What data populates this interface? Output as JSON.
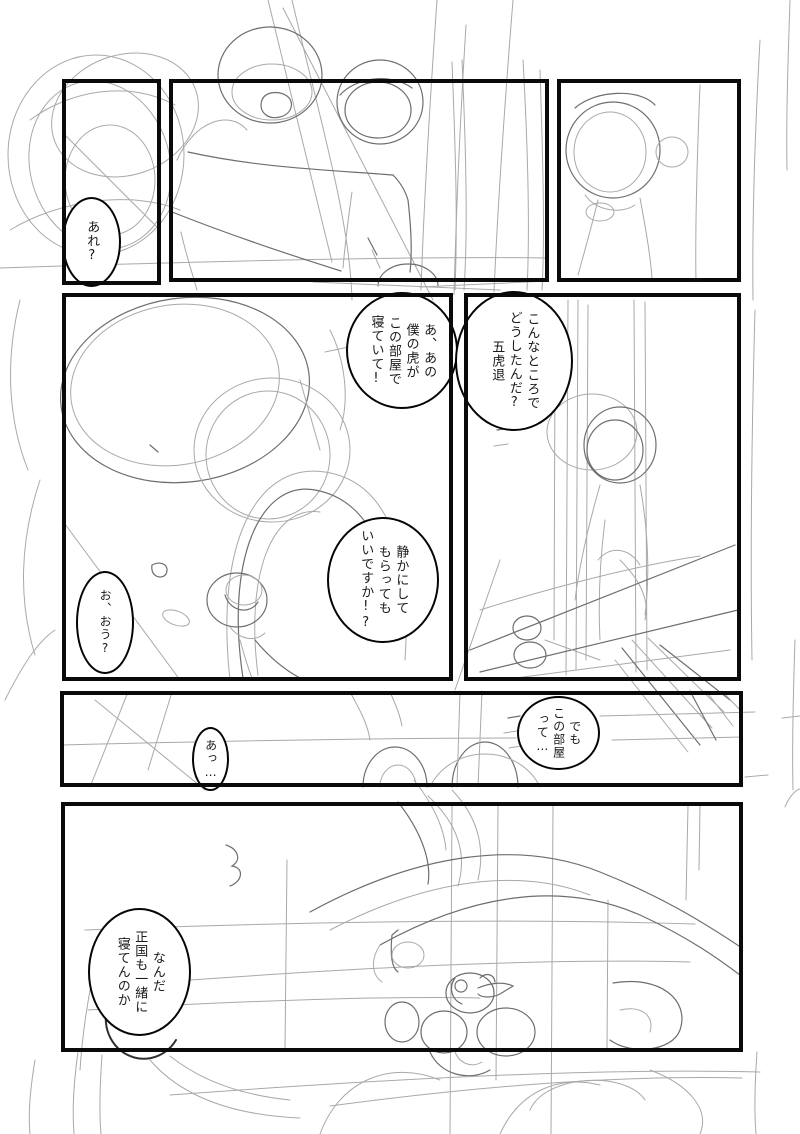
{
  "page": {
    "type": "manga-name-rough-sketch",
    "colors": {
      "bg": "#ffffff",
      "panel_border": "#0a0a0a",
      "bubble_border": "#050505",
      "text": "#1a1a1a",
      "sketch_light": "#a9a9a9",
      "sketch_dark": "#6e6e6e",
      "sketch_darkest": "#2f2f2f"
    }
  },
  "bubbles": {
    "are": {
      "text": "あれ?"
    },
    "boku_no_tora": {
      "text": "あ、あの\n僕の虎が\nこの部屋で\n寝ていて!"
    },
    "gokotai": {
      "text": "こんなところで\nどうしたんだ?\n五虎退"
    },
    "shizuka": {
      "text": "静かにして\nもらっても\nいいですか!?"
    },
    "oou": {
      "text": "お、おう?"
    },
    "demo_kono_heya": {
      "text": "でも\nこの部屋\nって…"
    },
    "a": {
      "text": "あっ…"
    },
    "nanda": {
      "text": "なんだ\n正国も一緒に\n寝てんのか"
    }
  }
}
